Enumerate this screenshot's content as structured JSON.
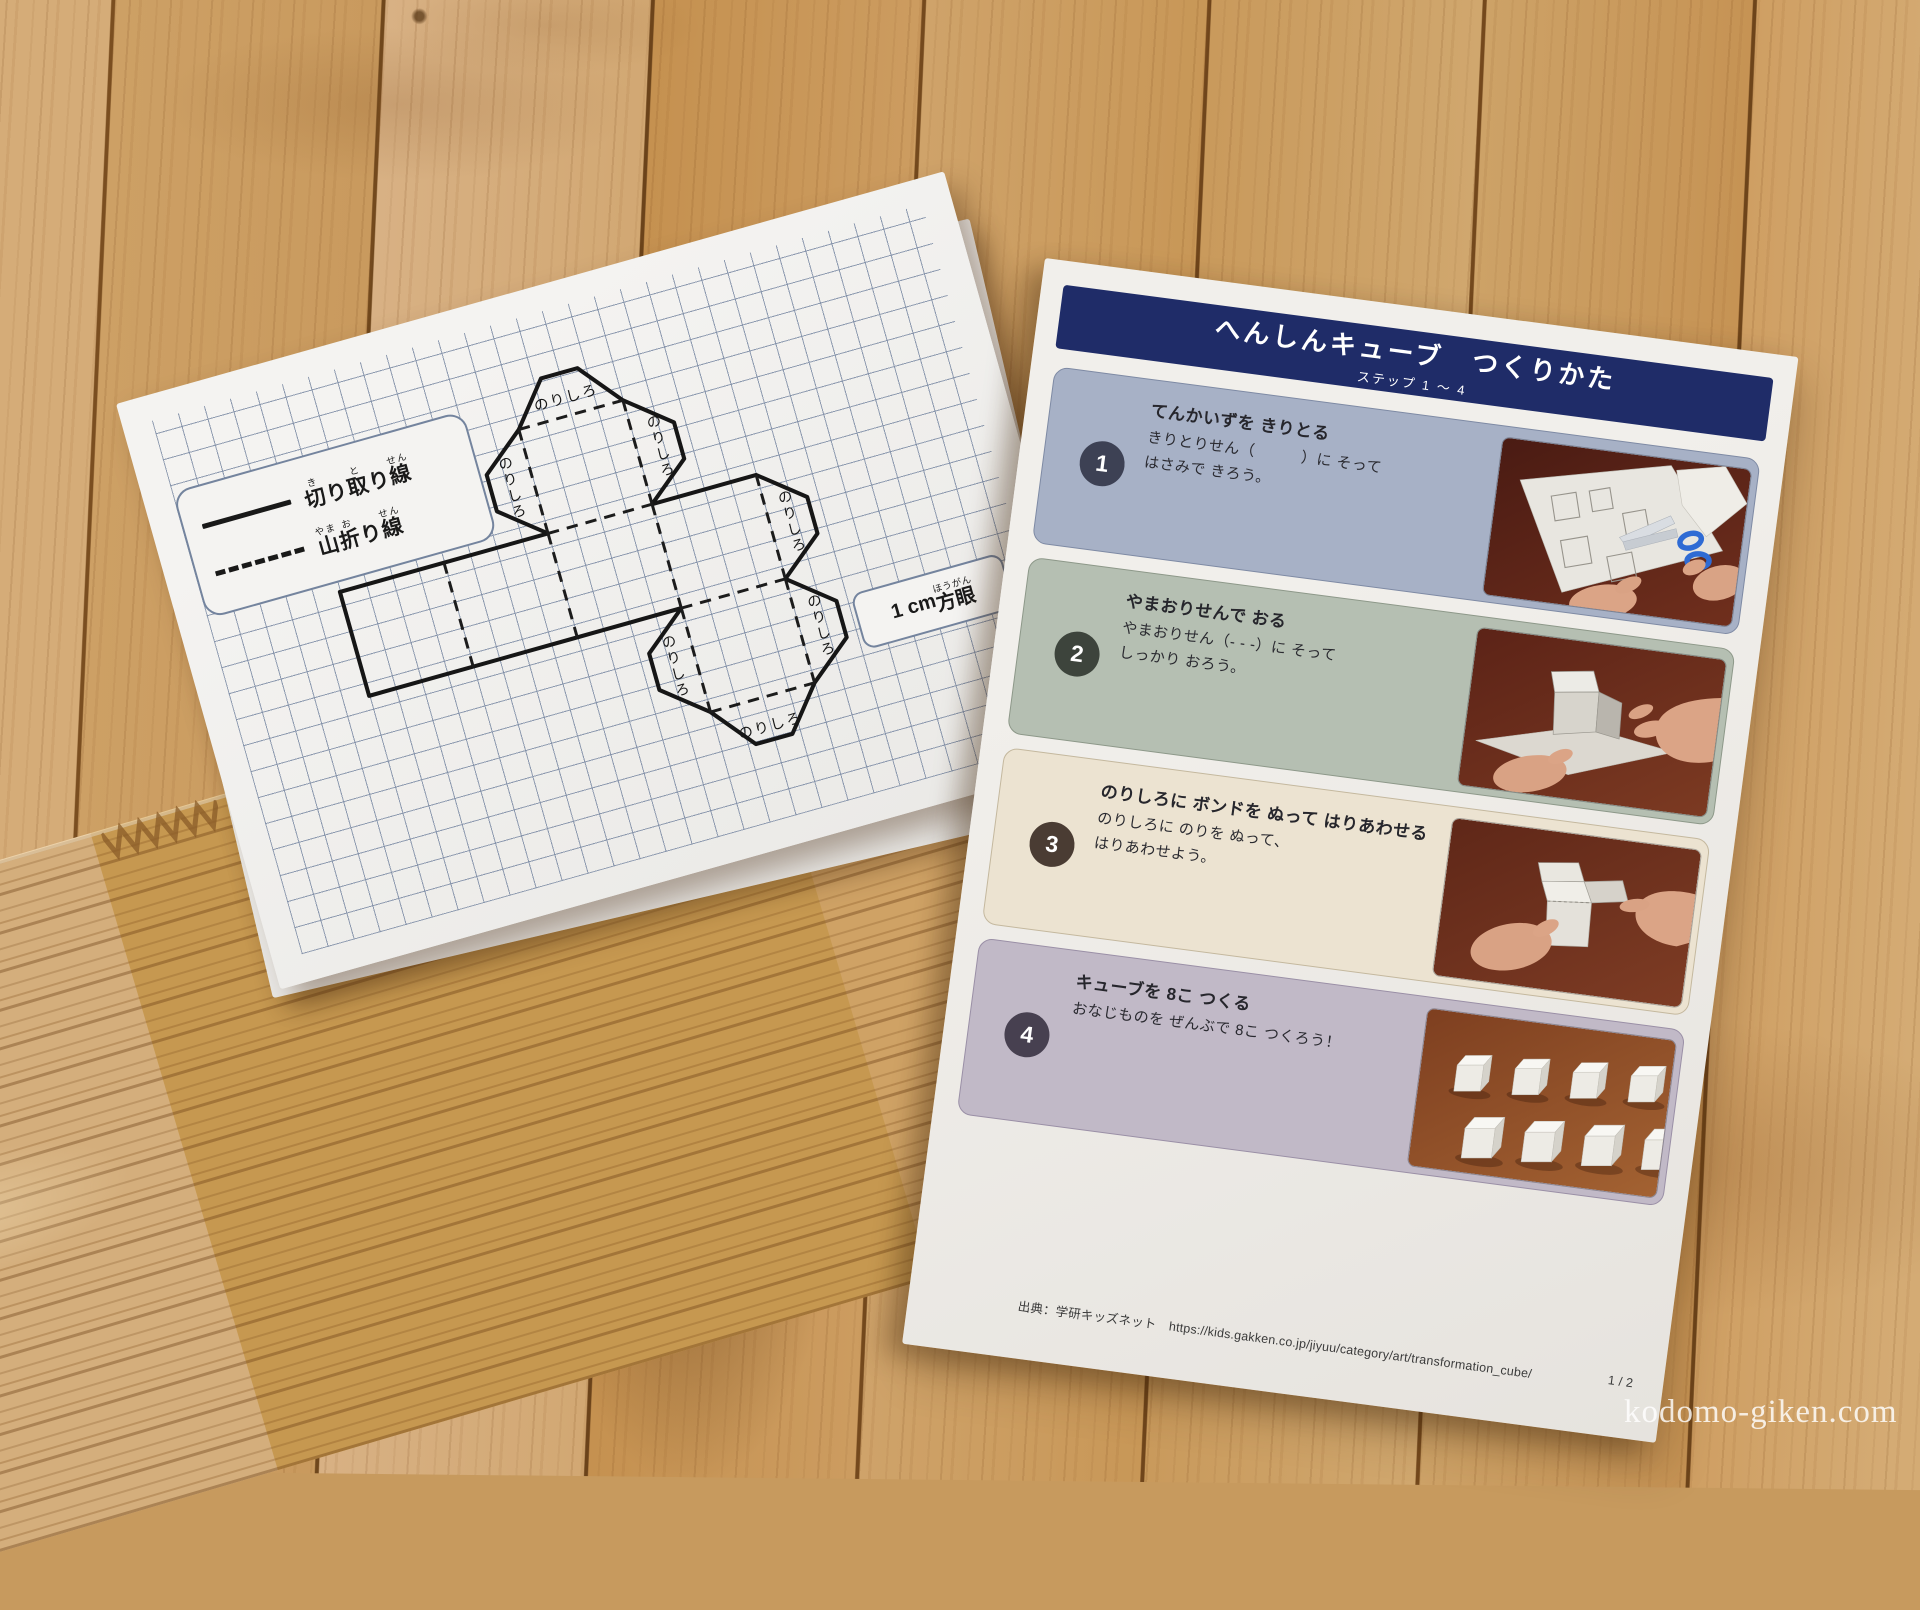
{
  "watermark": "kodomo-giken.com",
  "template_sheet": {
    "legend": {
      "cut_line_ruby": [
        [
          "切",
          "き"
        ],
        [
          "り",
          ""
        ],
        [
          "取",
          "と"
        ],
        [
          "り",
          ""
        ],
        [
          "線",
          "せん"
        ]
      ],
      "fold_line_ruby": [
        [
          "山",
          "やま"
        ],
        [
          "折",
          "お"
        ],
        [
          "り",
          ""
        ],
        [
          "線",
          "せん"
        ]
      ]
    },
    "glue_tab_label": "のりしろ",
    "scale_badge": {
      "prefix": "1 cm ",
      "ruby": [
        [
          "方眼",
          "ほうがん"
        ]
      ]
    }
  },
  "instruction_sheet": {
    "header": {
      "title": "へんしんキューブ　つくりかた",
      "subtitle": "ステップ 1 〜 4",
      "bg_color": "#1f2c68"
    },
    "steps": [
      {
        "num": "1",
        "heading": "てんかいずを きりとる",
        "body": "きりとりせん（　　　）に そって\nはさみで きろう。",
        "panel_color": "#a7b1c6",
        "border_color": "#7e8aa4",
        "circle_color": "#3d4154",
        "photo": "cutting-net-with-scissors"
      },
      {
        "num": "2",
        "heading": "やまおりせんで おる",
        "body": "やまおりせん（- - -）に そって\nしっかり おろう。",
        "panel_color": "#b5bfb2",
        "border_color": "#8d9889",
        "circle_color": "#3d443c",
        "photo": "folding-cube-by-hand"
      },
      {
        "num": "3",
        "heading": "のりしろに ボンドを ぬって はりあわせる",
        "body": "のりしろに のりを ぬって、\nはりあわせよう。",
        "panel_color": "#ece3d1",
        "border_color": "#c4b89e",
        "circle_color": "#4a3c33",
        "photo": "gluing-glue-tabs"
      },
      {
        "num": "4",
        "heading": "キューブを 8こ つくる",
        "body": "おなじものを ぜんぶで 8こ つくろう！",
        "panel_color": "#c1b9c7",
        "border_color": "#9a8fa6",
        "circle_color": "#474050",
        "photo": "eight-finished-cubes"
      }
    ],
    "footer": {
      "source": "出典：学研キッズネット　https://kids.gakken.co.jp/jiyuu/category/art/transformation_cube/",
      "page": "1 / 2"
    }
  }
}
